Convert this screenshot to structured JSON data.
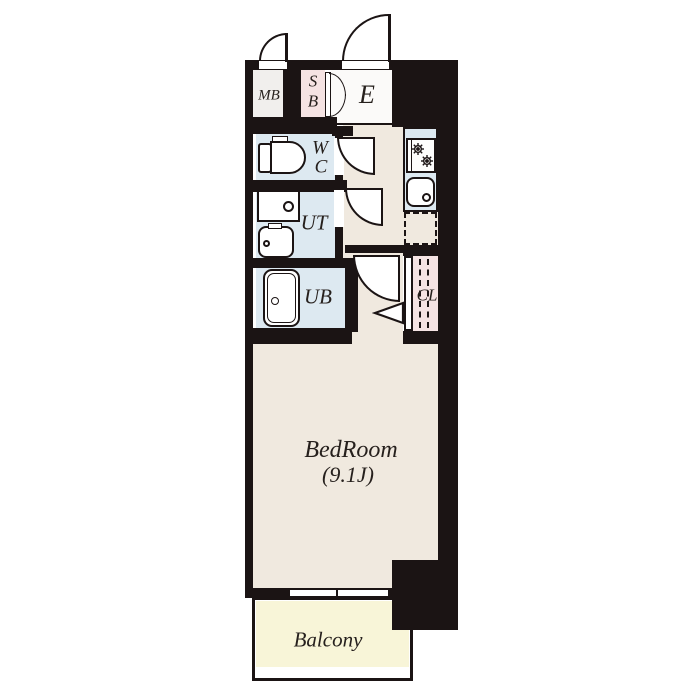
{
  "title": "apartment-floor-plan",
  "colors": {
    "wall": "#1b1414",
    "floor-beige": "#f0e9df",
    "wet-blue": "#dde9f1",
    "closet-pink": "#f5e3e3",
    "balcony-yellow": "#f8f5d8",
    "room-white": "#fbfaf9",
    "mb-gray": "#f1efed",
    "text": "#26201d",
    "canvas": "#ffffff"
  },
  "rooms": {
    "mb": {
      "label": "MB"
    },
    "sb": {
      "line1": "S",
      "line2": "B"
    },
    "entrance": {
      "label": "E"
    },
    "wc": {
      "line1": "W",
      "line2": "C"
    },
    "ut": {
      "label": "UT"
    },
    "ub": {
      "label": "UB"
    },
    "cl": {
      "label": "CL"
    },
    "bedroom": {
      "label": "BedRoom",
      "size": "(9.1J)"
    },
    "balcony": {
      "label": "Balcony"
    }
  },
  "icons": {
    "toilet-icon": "tank + D-shaped bowl outline",
    "washing-machine-pan-icon": "square pan with drain circle",
    "washbasin-icon": "rounded basin with drain circle",
    "bathtub-icon": "rounded tub with drain circle",
    "gas-stove-icon": "box with two wheel burners",
    "kitchen-sink-icon": "rounded sink with drain circle",
    "refrigerator-space-icon": "dashed square",
    "closet-rail-icon": "vertical dashed lines",
    "door-swing-icon": "quarter-circle arc",
    "folding-door-icon": "triangle",
    "sliding-window-icon": "two white panels in wall"
  }
}
